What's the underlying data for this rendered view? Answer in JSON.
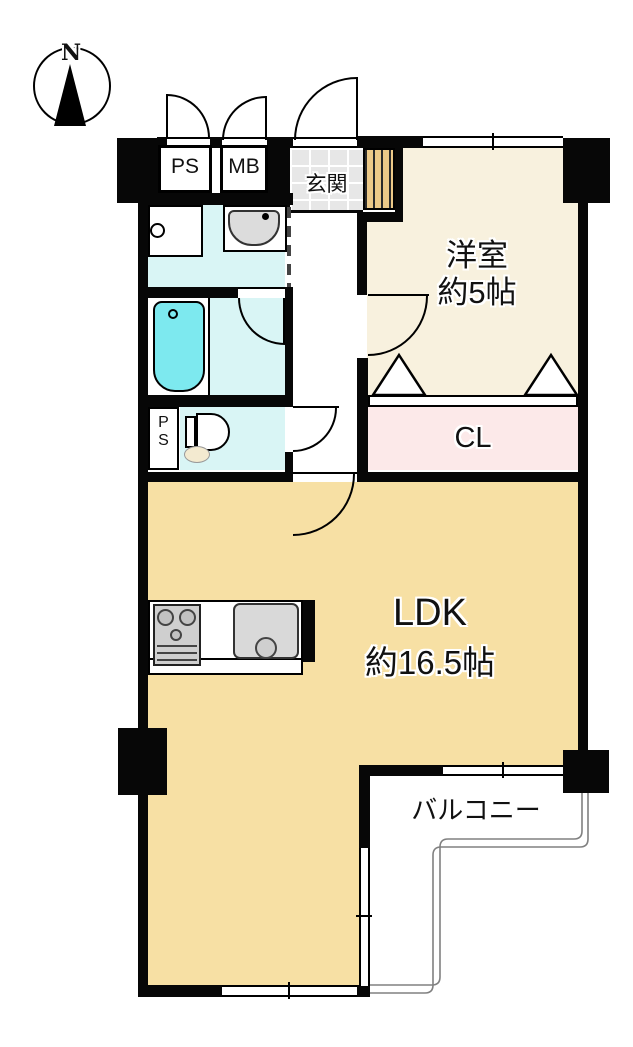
{
  "compass": {
    "north_label": "N"
  },
  "labels": {
    "ps_top": "PS",
    "meter_box": "MB",
    "genkan": "玄関",
    "western_room_name": "洋室",
    "western_room_size": "約5帖",
    "closet": "CL",
    "ps_side_line1": "P",
    "ps_side_line2": "S",
    "ldk_name": "LDK",
    "ldk_size": "約16.5帖",
    "balcony": "バルコニー"
  },
  "colors": {
    "wall": "#070707",
    "ldk_floor": "#f7e0a4",
    "western_room_floor": "#f8f1de",
    "closet_floor": "#fce9e9",
    "wet_area_floor": "#d9f5f5",
    "bathtub": "#7de9ef",
    "genkan_tile": "#e7e7e7",
    "shoe_cabinet": "#ecc988",
    "fixture_gray": "#d6d6d6",
    "railing": "#808080"
  }
}
